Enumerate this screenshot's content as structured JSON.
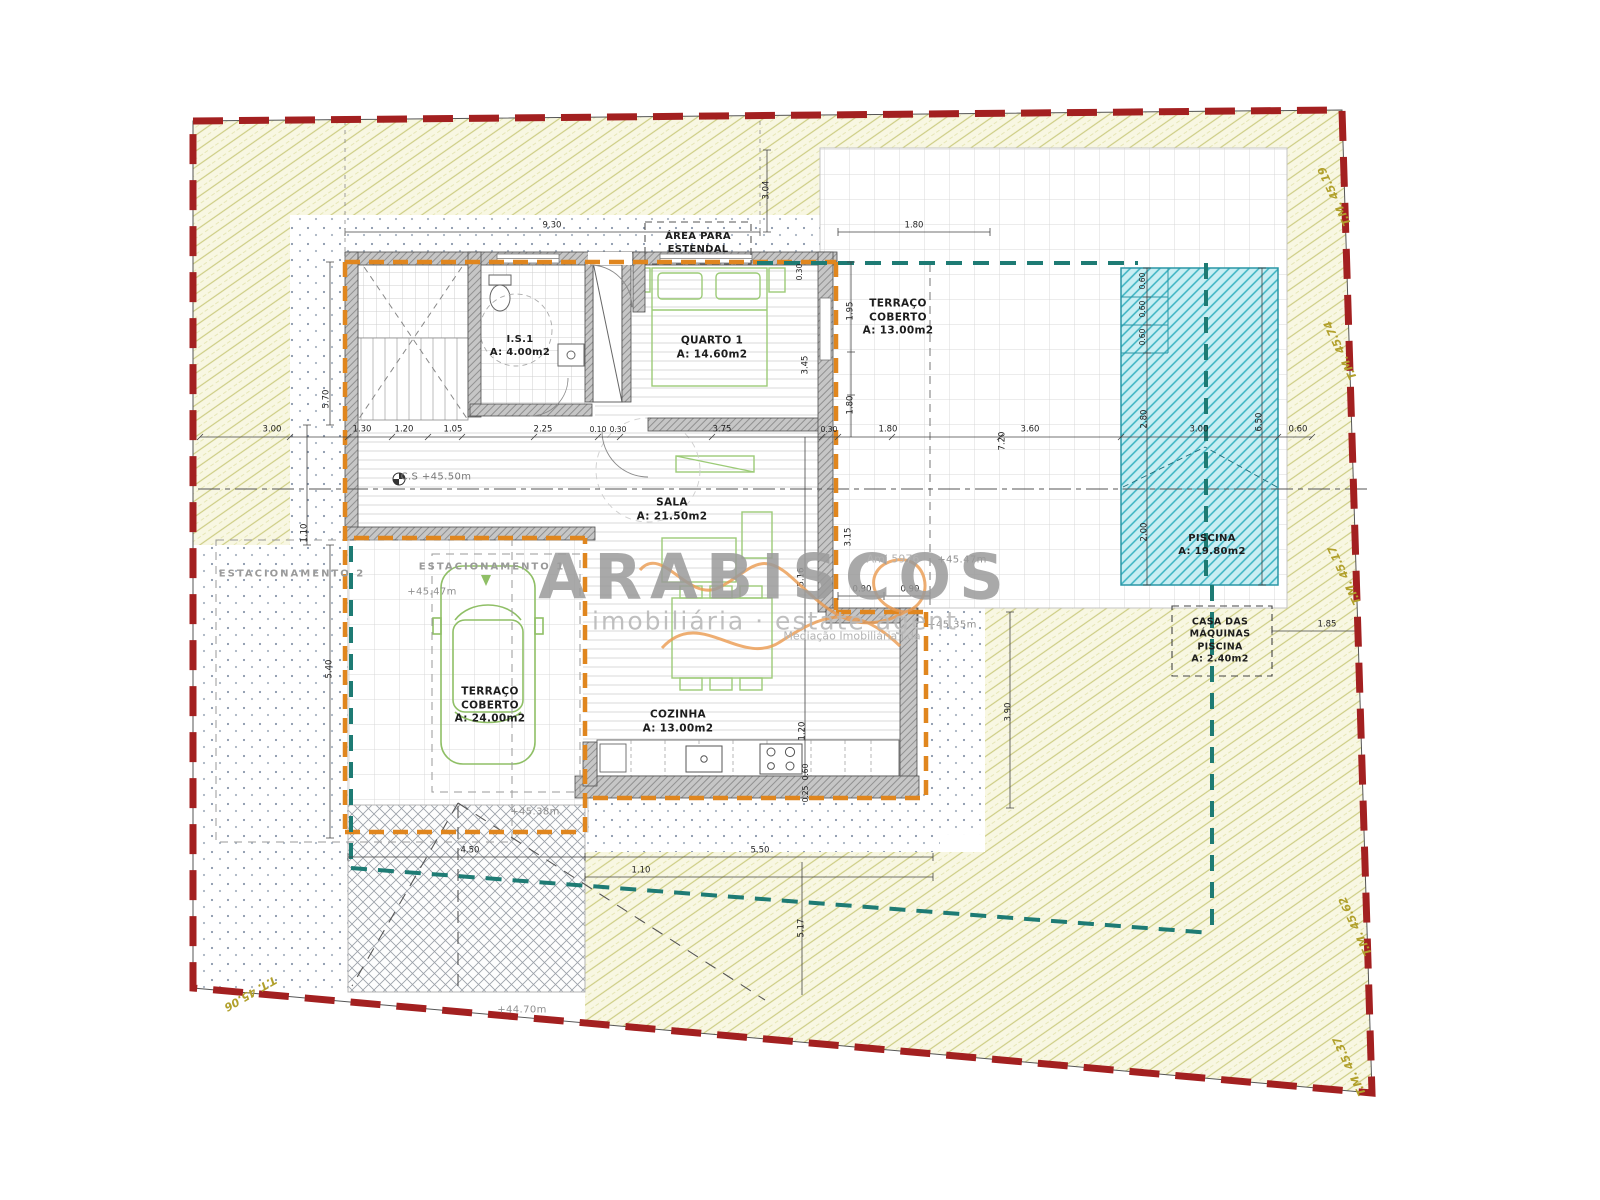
{
  "watermark": {
    "brand": "ARABISCOS",
    "tagline": "imobiliária · estate agent",
    "subtext": "Mediação Imobiliária Lda",
    "license": "Ami 5976"
  },
  "rooms": [
    {
      "name": "label-area-estendal",
      "lines": [
        "ÁREA PARA",
        "ESTENDAL"
      ],
      "x": 698,
      "y": 243,
      "size": 10
    },
    {
      "name": "label-is1",
      "lines": [
        "I.S.1",
        "A: 4.00m2"
      ],
      "x": 520,
      "y": 346,
      "size": 10
    },
    {
      "name": "label-quarto1",
      "lines": [
        "QUARTO 1",
        "A: 14.60m2"
      ],
      "x": 712,
      "y": 348,
      "size": 10.5
    },
    {
      "name": "label-terraco-coberto-13",
      "lines": [
        "TERRAÇO",
        "COBERTO",
        "A: 13.00m2"
      ],
      "x": 898,
      "y": 318,
      "size": 10.5
    },
    {
      "name": "label-sala",
      "lines": [
        "SALA",
        "A: 21.50m2"
      ],
      "x": 672,
      "y": 510,
      "size": 10.5
    },
    {
      "name": "label-cozinha",
      "lines": [
        "COZINHA",
        "A: 13.00m2"
      ],
      "x": 678,
      "y": 722,
      "size": 10.5
    },
    {
      "name": "label-terraco-coberto-24",
      "lines": [
        "TERRAÇO",
        "COBERTO",
        "A: 24.00m2"
      ],
      "x": 490,
      "y": 706,
      "size": 10.5
    },
    {
      "name": "label-estacionamento-1",
      "lines": [
        "ESTACIONAMENTO 1"
      ],
      "x": 492,
      "y": 567,
      "size": 10,
      "color": "#9a9a9a",
      "ls": 2
    },
    {
      "name": "label-estacionamento-2",
      "lines": [
        "ESTACIONAMENTO 2"
      ],
      "x": 292,
      "y": 574,
      "size": 10,
      "color": "#9a9a9a",
      "ls": 2
    },
    {
      "name": "label-piscina",
      "lines": [
        "PISCINA",
        "A: 19.80m2"
      ],
      "x": 1212,
      "y": 545,
      "size": 10
    },
    {
      "name": "label-casa-das-maquinas",
      "lines": [
        "CASA DAS",
        "MÁQUINAS",
        "PISCINA",
        "A: 2.40m2"
      ],
      "x": 1220,
      "y": 641,
      "size": 9.5
    }
  ],
  "elevations": [
    {
      "text": "C.S +45.50m",
      "x": 436,
      "y": 477,
      "color": "#777777"
    },
    {
      "text": "+45.47m",
      "x": 432,
      "y": 592
    },
    {
      "text": "+45.47m",
      "x": 962,
      "y": 560
    },
    {
      "text": "+45.35m",
      "x": 952,
      "y": 625
    },
    {
      "text": "+45.38m",
      "x": 535,
      "y": 812
    },
    {
      "text": "+44.70m",
      "x": 522,
      "y": 1010
    }
  ],
  "dimensions": [
    {
      "text": "9.30",
      "x": 552,
      "y": 226
    },
    {
      "text": "1.80",
      "x": 914,
      "y": 226
    },
    {
      "text": "3.04",
      "x": 767,
      "y": 190,
      "rot": -90
    },
    {
      "text": "3.00",
      "x": 272,
      "y": 430
    },
    {
      "text": "1.30",
      "x": 362,
      "y": 430
    },
    {
      "text": "1.20",
      "x": 404,
      "y": 430
    },
    {
      "text": "1.05",
      "x": 453,
      "y": 430
    },
    {
      "text": "2.25",
      "x": 543,
      "y": 430
    },
    {
      "text": "0.10",
      "x": 598,
      "y": 430,
      "size": 7.5
    },
    {
      "text": "0.30",
      "x": 618,
      "y": 430,
      "size": 7.5
    },
    {
      "text": "3.75",
      "x": 722,
      "y": 430
    },
    {
      "text": "0.30",
      "x": 829,
      "y": 430,
      "size": 7.5
    },
    {
      "text": "1.80",
      "x": 888,
      "y": 430
    },
    {
      "text": "7.20",
      "x": 1003,
      "y": 441,
      "rot": -90
    },
    {
      "text": "3.60",
      "x": 1030,
      "y": 430
    },
    {
      "text": "3.00",
      "x": 1199,
      "y": 430
    },
    {
      "text": "0.60",
      "x": 1298,
      "y": 430
    },
    {
      "text": "5.70",
      "x": 327,
      "y": 399,
      "rot": -90
    },
    {
      "text": "1.10",
      "x": 305,
      "y": 533,
      "rot": -90
    },
    {
      "text": "5.40",
      "x": 330,
      "y": 669,
      "rot": -90
    },
    {
      "text": "0.30",
      "x": 800,
      "y": 272,
      "rot": -90,
      "size": 7.5
    },
    {
      "text": "1.95",
      "x": 851,
      "y": 311,
      "rot": -90
    },
    {
      "text": "3.45",
      "x": 806,
      "y": 365,
      "rot": -90
    },
    {
      "text": "1.80",
      "x": 851,
      "y": 405,
      "rot": -90
    },
    {
      "text": "3.15",
      "x": 849,
      "y": 537,
      "rot": -90
    },
    {
      "text": "5.16",
      "x": 802,
      "y": 577,
      "rot": -90
    },
    {
      "text": "0.90",
      "x": 862,
      "y": 590
    },
    {
      "text": "0.90",
      "x": 910,
      "y": 590
    },
    {
      "text": "1.20",
      "x": 803,
      "y": 731,
      "rot": -90
    },
    {
      "text": "0.60",
      "x": 806,
      "y": 772,
      "rot": -90,
      "size": 7.5
    },
    {
      "text": "0.25",
      "x": 806,
      "y": 794,
      "rot": -90,
      "size": 7.5
    },
    {
      "text": "3.90",
      "x": 1009,
      "y": 712,
      "rot": -90
    },
    {
      "text": "1.85",
      "x": 1327,
      "y": 625
    },
    {
      "text": "0.60",
      "x": 1143,
      "y": 281,
      "rot": -90,
      "size": 7.5
    },
    {
      "text": "0.60",
      "x": 1143,
      "y": 309,
      "rot": -90,
      "size": 7.5
    },
    {
      "text": "0.60",
      "x": 1143,
      "y": 337,
      "rot": -90,
      "size": 7.5
    },
    {
      "text": "2.80",
      "x": 1145,
      "y": 419,
      "rot": -90
    },
    {
      "text": "2.00",
      "x": 1145,
      "y": 532,
      "rot": -90
    },
    {
      "text": "6.50",
      "x": 1260,
      "y": 422,
      "rot": -90
    },
    {
      "text": "4.50",
      "x": 470,
      "y": 851
    },
    {
      "text": "5.50",
      "x": 760,
      "y": 851
    },
    {
      "text": "1.10",
      "x": 641,
      "y": 871
    },
    {
      "text": "5.17",
      "x": 802,
      "y": 928,
      "rot": -90
    }
  ],
  "boundary_markers": [
    {
      "text": "T.M. 45.19",
      "x": 1335,
      "y": 196,
      "rot": -115
    },
    {
      "text": "T.M. 45.74",
      "x": 1341,
      "y": 350,
      "rot": -115
    },
    {
      "text": "T.M. 45.17",
      "x": 1345,
      "y": 575,
      "rot": -115
    },
    {
      "text": "T.M. 45.62",
      "x": 1356,
      "y": 926,
      "rot": -115
    },
    {
      "text": "T.M. 45.37",
      "x": 1350,
      "y": 1066,
      "rot": -115
    },
    {
      "text": "T.T. 45.06",
      "x": 250,
      "y": 993,
      "rot": 150
    }
  ],
  "colors": {
    "property_boundary": "#a32020",
    "covered_area_line": "#e0861e",
    "utility_line": "#1e7b74",
    "pool_fill": "#c9eef3",
    "pool_hatch": "#39b3c2",
    "garden_hatch": "#cdcd84",
    "furniture": "#9ccb77"
  }
}
